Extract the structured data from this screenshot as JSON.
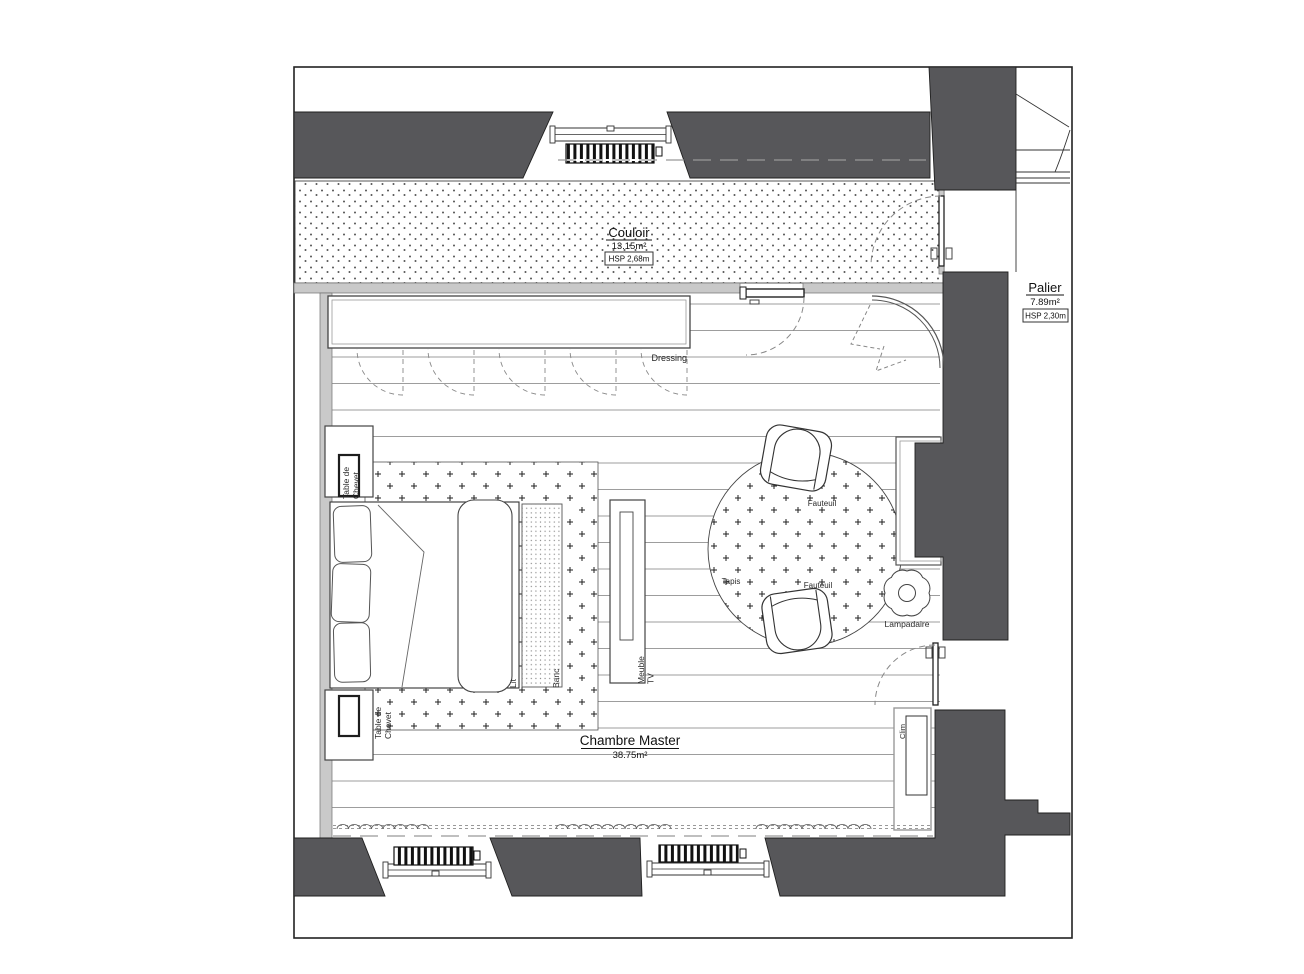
{
  "colors": {
    "wall_dark": "#57575a",
    "wall_light": "#c9c9c9",
    "line": "#333333"
  },
  "rooms": {
    "couloir": {
      "name": "Couloir",
      "area": "13.15m²",
      "height_note": "HSP 2,68m"
    },
    "palier": {
      "name": "Palier",
      "area": "7.89m²",
      "height_note": "HSP 2,30m"
    },
    "chambre": {
      "name": "Chambre Master",
      "area": "38.75m²"
    }
  },
  "labels": {
    "dressing": "Dressing",
    "table_de_chevet_l1": "Table de",
    "table_de_chevet_l2": "Chevet",
    "lit": "Lit",
    "banc": "Banc",
    "meuble_tv_l1": "Meuble",
    "meuble_tv_l2": "TV",
    "fauteuil": "Fauteuil",
    "tapis": "Tapis",
    "lampadaire": "Lampadaire",
    "clim": "Clim"
  }
}
